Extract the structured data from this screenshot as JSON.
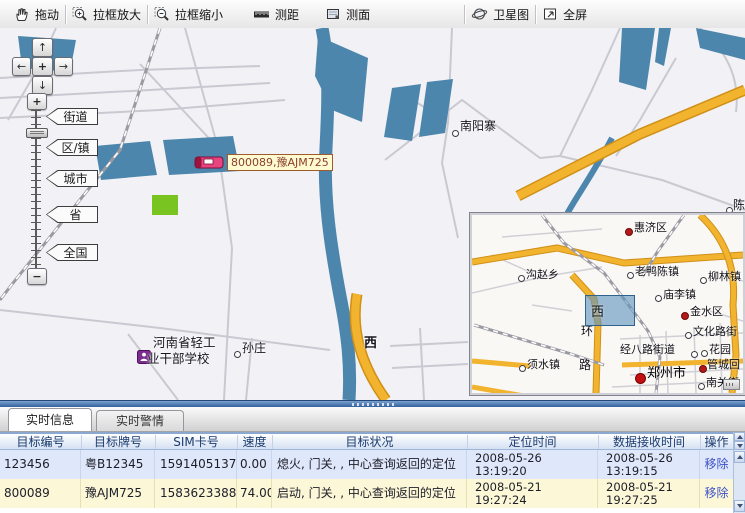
{
  "toolbar": {
    "buttons": [
      {
        "label": "拖动"
      },
      {
        "label": "拉框放大"
      },
      {
        "label": "拉框缩小"
      },
      {
        "label": "测距"
      },
      {
        "label": "测面"
      },
      {
        "label": "卫星图"
      },
      {
        "label": "全屏"
      }
    ]
  },
  "map": {
    "zoom_levels": [
      "街道",
      "区/镇",
      "城市",
      "省",
      "全国"
    ],
    "zoom_in": "+",
    "zoom_out": "−",
    "pan": {
      "up": "↑",
      "down": "↓",
      "left": "←",
      "right": "→",
      "center": "+"
    },
    "labels": {
      "nanyangzhai": "南阳寨",
      "sunzhuang": "孙庄",
      "school_line1": "河南省轻工",
      "school_line2": "业干部学校",
      "west_road": "西",
      "chenzhai": "陈砦"
    },
    "vehicle": {
      "label": "800089,豫AJM725"
    }
  },
  "minimap": {
    "view_label": "西",
    "road_label": {
      "char1": "环",
      "char2": "路"
    },
    "places": [
      {
        "text": "惠济区"
      },
      {
        "text": "沟赵乡"
      },
      {
        "text": "老鸭陈镇"
      },
      {
        "text": "柳林镇"
      },
      {
        "text": "庙李镇"
      },
      {
        "text": "金水区"
      },
      {
        "text": "文化路街"
      },
      {
        "text": "经八路街道"
      },
      {
        "text": "花园"
      },
      {
        "text": "管城回"
      },
      {
        "text": "郑州市"
      },
      {
        "text": "南关街"
      },
      {
        "text": "须水镇"
      }
    ]
  },
  "tabs": [
    {
      "label": "实时信息"
    },
    {
      "label": "实时警情"
    }
  ],
  "table": {
    "columns": [
      "目标编号",
      "目标牌号",
      "SIM卡号",
      "速度",
      "目标状况",
      "定位时间",
      "数据接收时间",
      "操作"
    ],
    "rows": [
      {
        "id": "123456",
        "plate": "粤B12345",
        "sim": "15914051378",
        "speed": "0.00",
        "status": "熄火, 门关, , 中心查询返回的定位",
        "loc_date": "2008-05-26",
        "loc_time": "13:19:20",
        "recv_date": "2008-05-26",
        "recv_time": "13:19:15",
        "action": "移除"
      },
      {
        "id": "800089",
        "plate": "豫AJM725",
        "sim": "15836233884",
        "speed": "74.00",
        "status": "启动, 门关, , 中心查询返回的定位",
        "loc_date": "2008-05-21",
        "loc_time": "19:27:24",
        "recv_date": "2008-05-21",
        "recv_time": "19:27:25",
        "action": "移除"
      }
    ]
  },
  "colors": {
    "water": "#4d86ad",
    "road_yellow": "#f2b32e",
    "row_blue": "#dfe8fa",
    "row_yellow": "#fcf8d7",
    "link_blue": "#3c50c8",
    "vehicle_label_bg": "#fffbd0",
    "splitter_blue": "#33619c"
  }
}
